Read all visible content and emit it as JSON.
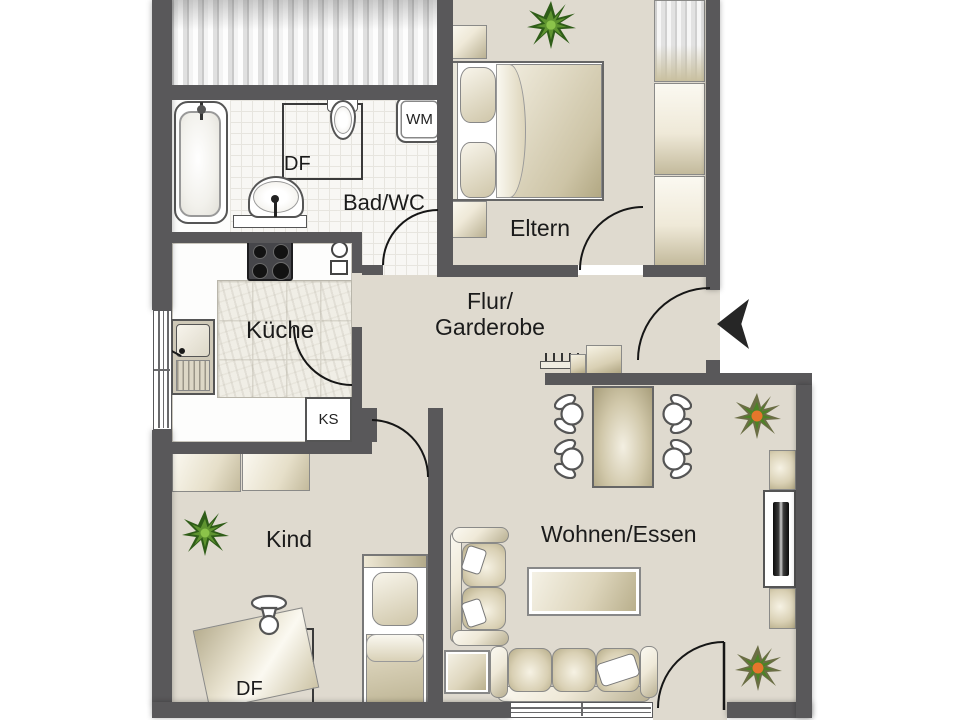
{
  "rooms": {
    "bad": {
      "label": "Bad/WC"
    },
    "eltern": {
      "label": "Eltern"
    },
    "kueche": {
      "label": "Küche"
    },
    "flur": {
      "line1": "Flur/",
      "line2": "Garderobe"
    },
    "kind": {
      "label": "Kind"
    },
    "wohnen": {
      "label": "Wohnen/Essen"
    }
  },
  "markers": {
    "wm": "WM",
    "ks": "KS",
    "df_bad": "DF",
    "df_kind": "DF"
  },
  "colors": {
    "wall": "#59585a",
    "floor_beige": "#dfdacf",
    "bath_tile": "#f8f7f4",
    "kitchen_tile": "#f0eee6",
    "furniture_beige": "#d6cdb2",
    "fixture_white": "#ffffff",
    "plant_dark_green": "#2f5d18",
    "plant_light_green": "#5f9430",
    "plant_accent_orange": "#e5762b",
    "tv_black": "#161616",
    "outline_dark": "#161616"
  }
}
